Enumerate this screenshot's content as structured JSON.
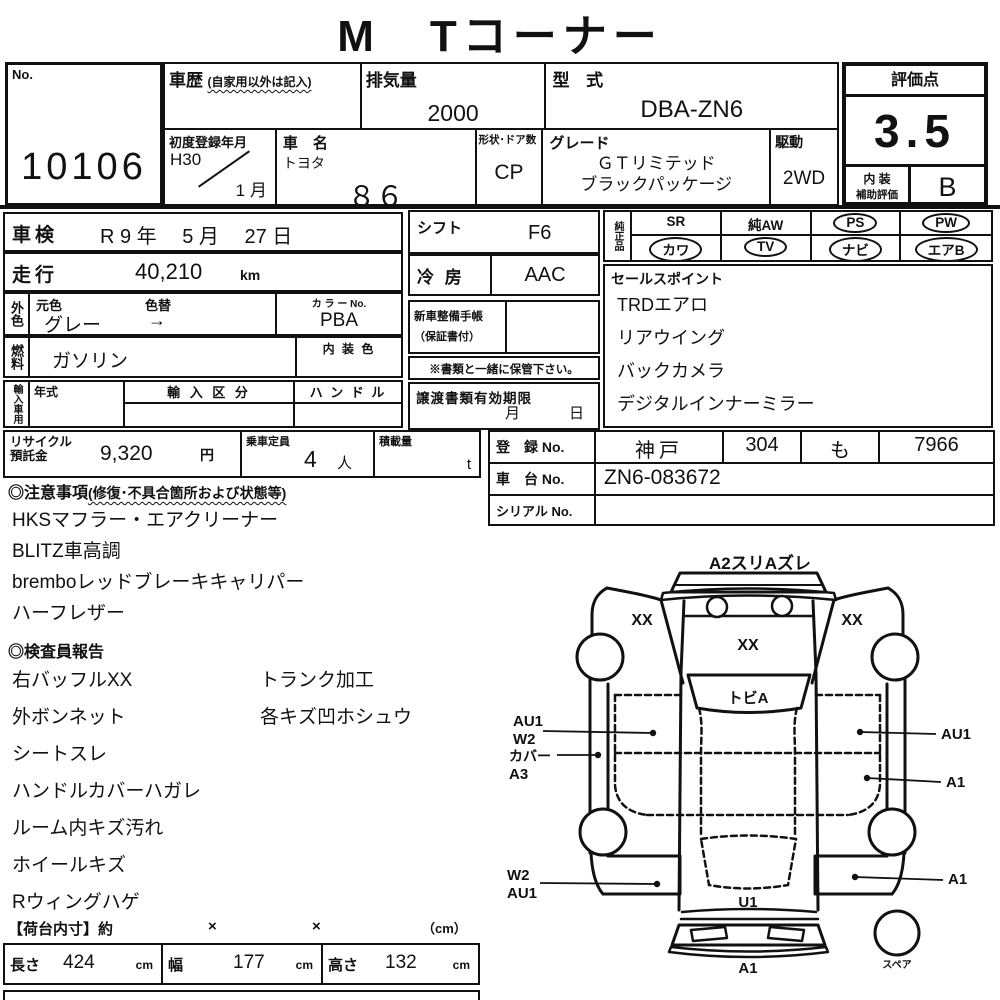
{
  "title": "M　Tコーナー",
  "no_box": {
    "label": "No.",
    "value": "10106"
  },
  "history": {
    "label": "車歴",
    "note": "(自家用以外は記入)"
  },
  "displacement": {
    "label": "排気量",
    "value": "2000"
  },
  "model_code": {
    "label": "型 式",
    "value": "DBA-ZN6"
  },
  "first_reg": {
    "label": "初度登録年月",
    "year": "H30",
    "month": "1 月"
  },
  "car_name": {
    "label": "車　名",
    "maker": "トヨタ",
    "model": "８６"
  },
  "body_doors": {
    "label": "形状･ドア数",
    "value": "CP"
  },
  "grade": {
    "label": "グレード",
    "line1": "ＧＴリミテッド",
    "line2": "ブラックパッケージ"
  },
  "drive": {
    "label": "駆動",
    "value": "2WD"
  },
  "score": {
    "label": "評価点",
    "value": "3.5",
    "interior_label1": "内 装",
    "interior_label2": "補助評価",
    "interior_value": "B"
  },
  "shaken": {
    "label": "車検",
    "value": "R 9 年　 5 月　 27 日"
  },
  "mileage": {
    "label": "走行",
    "value": "40,210",
    "unit": "km"
  },
  "ext_color": {
    "stub": "外色",
    "orig_label": "元色",
    "change_label": "色替",
    "value": "グレー",
    "arrow": "→",
    "color_no_label": "カ ラ ー No.",
    "color_no": "PBA"
  },
  "fuel": {
    "stub": "燃料",
    "value": "ガソリン",
    "interior_color_label": "内 装 色"
  },
  "import_row": {
    "stub": "輸入車用",
    "year_label": "年式",
    "division_label": "輸 入 区 分",
    "handle_label": "ハ ン ド ル"
  },
  "shift": {
    "label": "シフト",
    "value": "F6"
  },
  "ac": {
    "label": "冷 房",
    "value": "AAC"
  },
  "maintenance_book": {
    "line1": "新車整備手帳",
    "line2": "（保証書付）"
  },
  "keep_note": "※書類と一緒に保管下さい。",
  "transfer_docs": {
    "label": "譲渡書類有効期限",
    "month": "月",
    "day": "日"
  },
  "recycle": {
    "label1": "リサイクル",
    "label2": "預託金",
    "value": "9,320",
    "unit": "円"
  },
  "capacity": {
    "label": "乗車定員",
    "value": "4",
    "unit": "人"
  },
  "load": {
    "label": "積載量",
    "unit": "t"
  },
  "equipment": {
    "stub": "純正品",
    "row1": [
      {
        "label": "SR",
        "circled": false
      },
      {
        "label": "純AW",
        "circled": false
      },
      {
        "label": "PS",
        "circled": true
      },
      {
        "label": "PW",
        "circled": true
      }
    ],
    "row2": [
      {
        "label": "カワ",
        "circled": true
      },
      {
        "label": "TV",
        "circled": true
      },
      {
        "label": "ナビ",
        "circled": true
      },
      {
        "label": "エアB",
        "circled": true
      }
    ]
  },
  "sales_points": {
    "title": "セールスポイント",
    "items": [
      "TRDエアロ",
      "リアウイング",
      "バックカメラ",
      "デジタルインナーミラー"
    ]
  },
  "registration": {
    "label": "登　録  No.",
    "region": "神戸",
    "class_no": "304",
    "kana": "も",
    "number": "7966"
  },
  "chassis": {
    "label": "車　台  No.",
    "value": "ZN6-083672"
  },
  "serial": {
    "label": "シリアル No.",
    "value": ""
  },
  "notes": {
    "title": "◎注意事項",
    "title_note": "(修復･不具合箇所および状態等)",
    "items": [
      "HKSマフラー・エアクリーナー",
      "BLITZ車高調",
      "bremboレッドブレーキキャリパー",
      "ハーフレザー"
    ]
  },
  "inspector_report": {
    "title": "◎検査員報告",
    "col1": [
      "右バッフルXX",
      "外ボンネット",
      "シートスレ",
      "ハンドルカバーハガレ",
      "ルーム内キズ汚れ",
      "ホイールキズ",
      "Rウィングハゲ"
    ],
    "col2": [
      "トランク加工",
      "各キズ凹ホシュウ"
    ]
  },
  "cargo": {
    "title": "【荷台内寸】約",
    "x1": "×",
    "x2": "×",
    "unit_note": "（cm）",
    "length_label": "長さ",
    "length": "424",
    "width_label": "幅",
    "width": "177",
    "height_label": "高さ",
    "height": "132",
    "cm": "cm"
  },
  "diagram": {
    "front_note": "A2スリAズレ",
    "left_door_mark": "XX",
    "hood_mark": "XX",
    "right_door_mark": "XX",
    "windshield_mark": "トビA",
    "left_front_callout_line1": "AU1",
    "left_front_callout_line2": "W2",
    "left_sill_callout_line1": "カバー",
    "left_sill_callout_line2": "A3",
    "right_front_callout": "AU1",
    "right_mid_callout": "A1",
    "left_rear_callout_line1": "W2",
    "left_rear_callout_line2": "AU1",
    "right_rear_callout": "A1",
    "rear_window_mark": "U1",
    "rear_bumper_mark": "A1",
    "spare_label": "スペア"
  }
}
